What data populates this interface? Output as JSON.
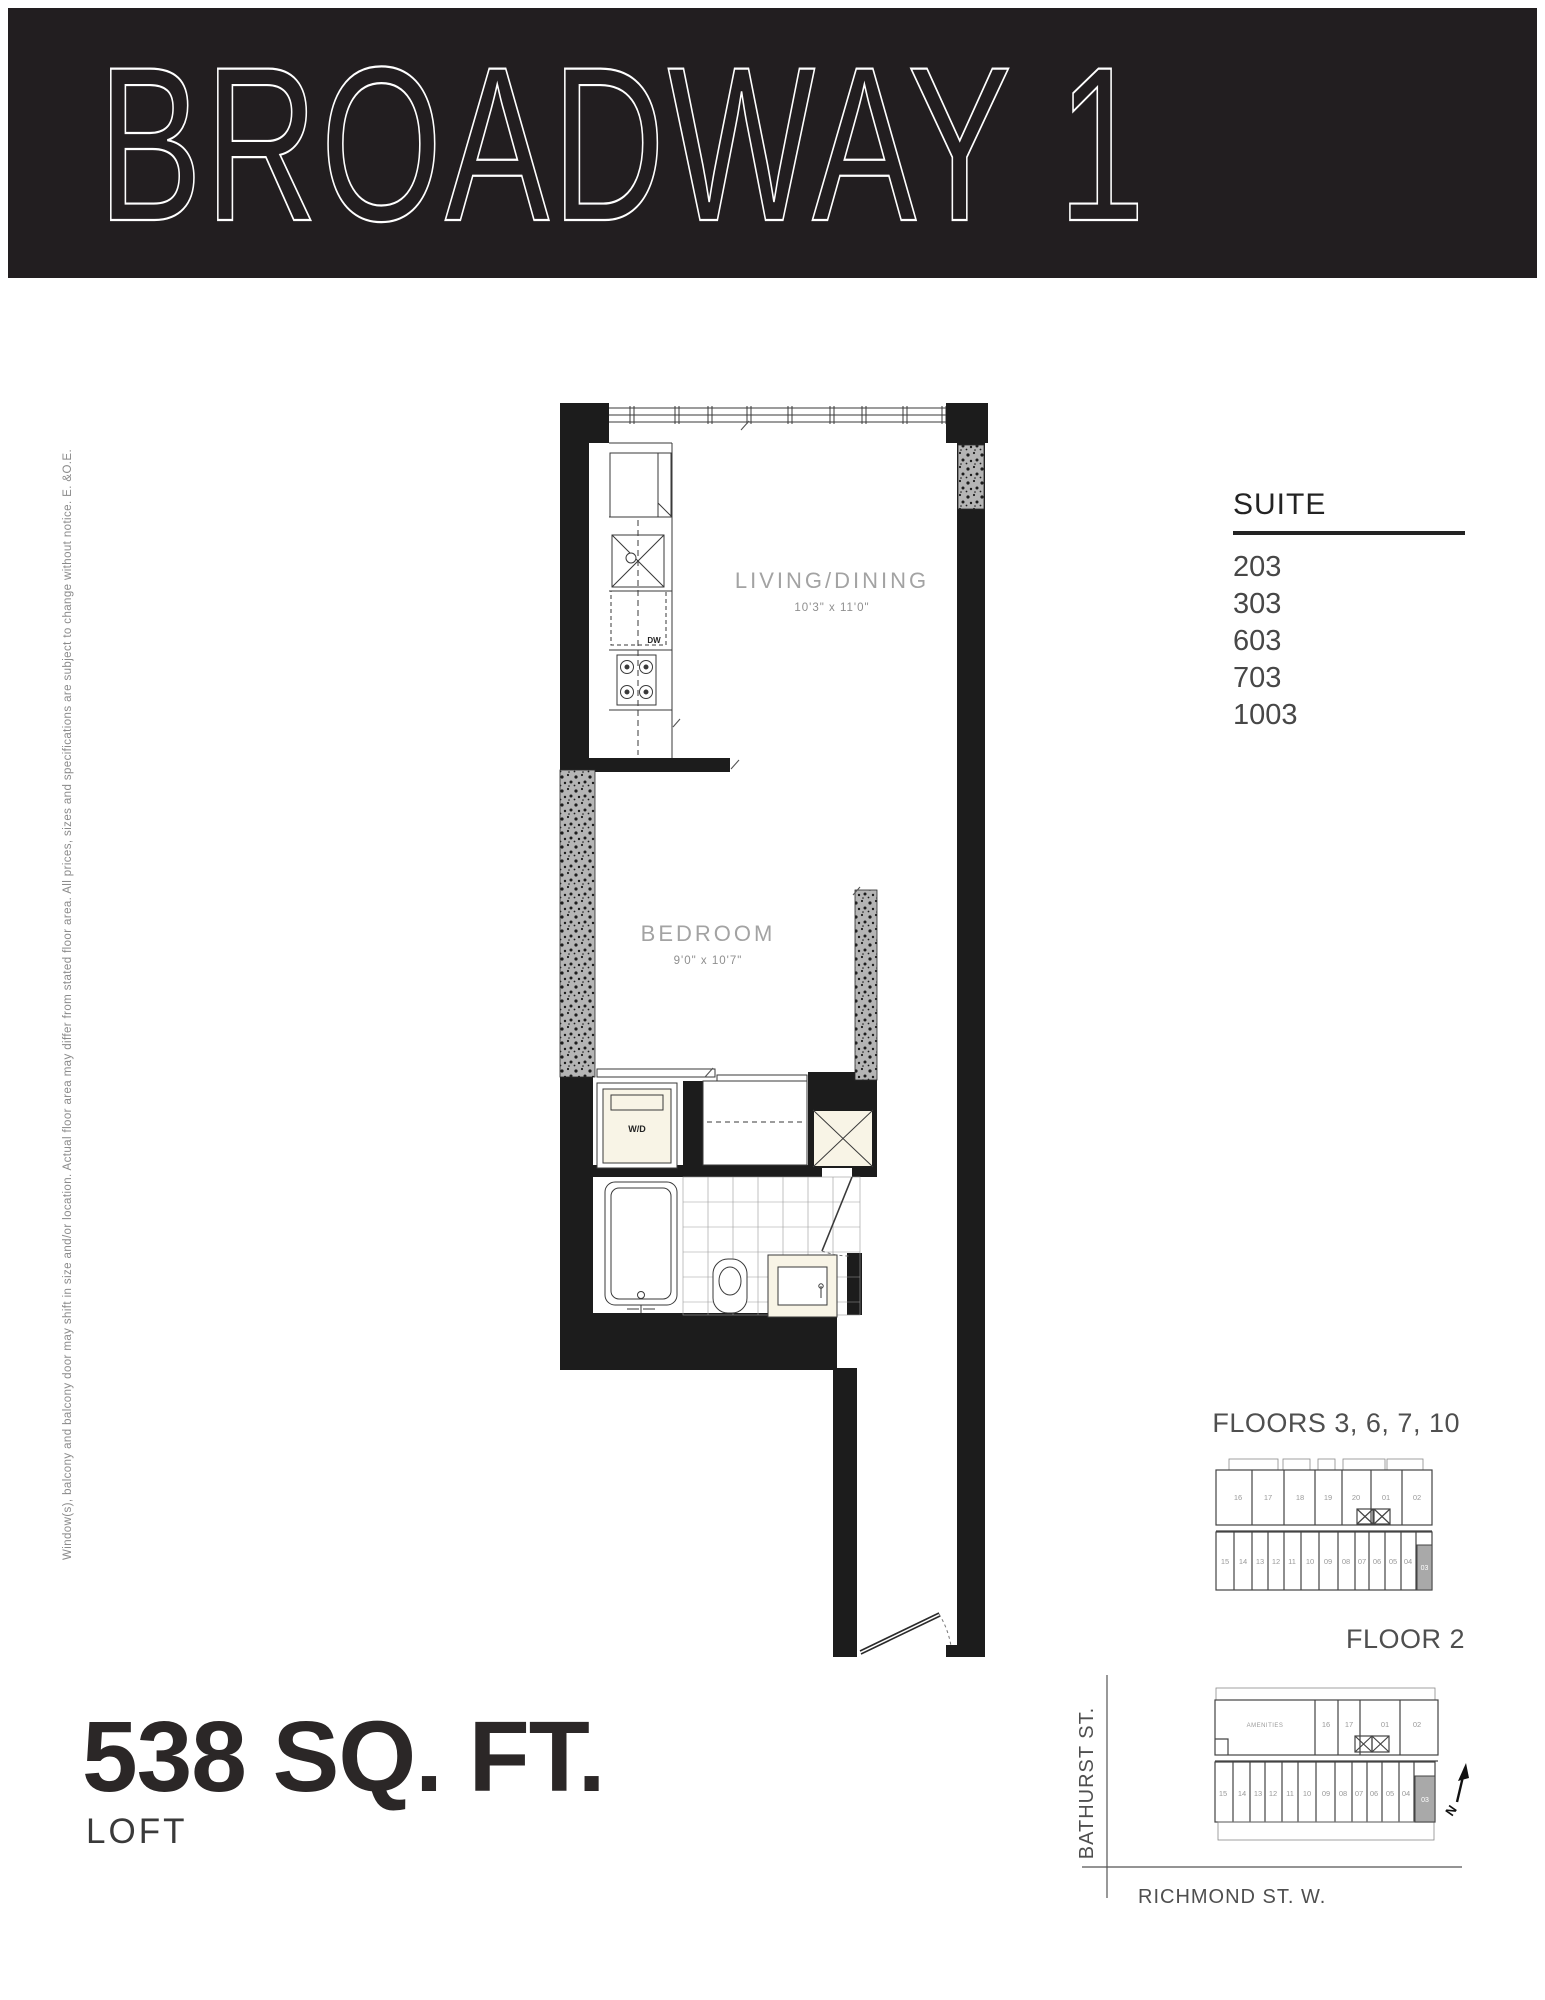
{
  "banner": {
    "title": "BROADWAY 1"
  },
  "suite_panel": {
    "heading": "SUITE",
    "suites": [
      "203",
      "303",
      "603",
      "703",
      "1003"
    ]
  },
  "floor_plan": {
    "rooms": [
      {
        "name": "LIVING/DINING",
        "dimensions": "10'3\" x 11'0\""
      },
      {
        "name": "BEDROOM",
        "dimensions": "9'0\" x 10'7\""
      }
    ],
    "fixture_labels": {
      "washer_dryer": "W/D",
      "dishwasher": "DW"
    }
  },
  "area_panel": {
    "size": "538 SQ. FT.",
    "type": "LOFT"
  },
  "keyplans": [
    {
      "title": "FLOORS 3, 6, 7, 10",
      "top_units": [
        "16",
        "17",
        "18",
        "19",
        "20",
        "01",
        "02"
      ],
      "bottom_units": [
        "15",
        "14",
        "13",
        "12",
        "11",
        "10",
        "09",
        "08",
        "07",
        "06",
        "05",
        "04"
      ],
      "highlighted_unit": "03"
    },
    {
      "title": "FLOOR 2",
      "amenities_label": "AMENITIES",
      "top_units": [
        "16",
        "17",
        "01",
        "02"
      ],
      "bottom_units": [
        "15",
        "14",
        "13",
        "12",
        "11",
        "10",
        "09",
        "08",
        "07",
        "06",
        "05",
        "04"
      ],
      "highlighted_unit": "03"
    }
  ],
  "map": {
    "street_vertical": "BATHURST ST.",
    "street_horizontal": "RICHMOND ST. W.",
    "north_label": "N"
  },
  "disclaimer": "Window(s), balcony and balcony door may shift in size and/or location. Actual floor area may differ from stated floor area. All prices, sizes and specifications are subject to change without notice. E. &O.E.",
  "colors": {
    "banner_bg": "#221e20",
    "wall_black": "#1c1c1c",
    "concrete_grey": "#b5b5b5",
    "fixture_cream": "#f8f4e6",
    "highlight_unit": "#a9a9a9"
  }
}
